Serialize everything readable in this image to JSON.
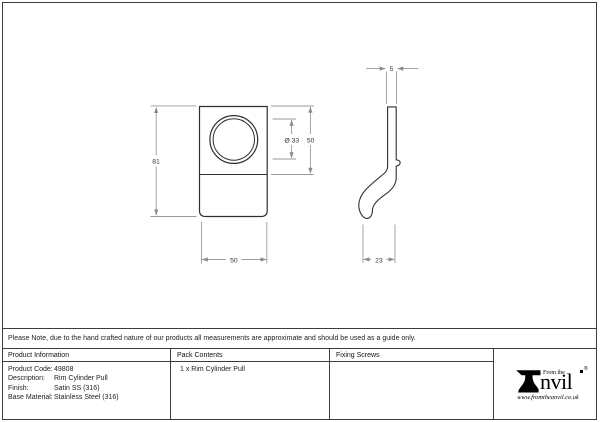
{
  "note_bar": {
    "text": "Please Note, due to the hand crafted nature of our products all measurements are approximate and should be used as a guide only."
  },
  "drawing": {
    "front_view": {
      "overall_height": "81",
      "overall_width": "50",
      "cylinder_diameter": "Ø 33",
      "cylinder_section_height": "50"
    },
    "side_view": {
      "plate_thickness": "5",
      "pull_depth": "23"
    }
  },
  "info_table": {
    "headers": {
      "product_information": "Product Information",
      "pack_contents": "Pack Contents",
      "fixing_screws": "Fixing Screws"
    },
    "product_information": {
      "rows": [
        {
          "label": "Product Code:",
          "value": "49808"
        },
        {
          "label": "Description:",
          "value": "Rim Cylinder Pull"
        },
        {
          "label": "Finish:",
          "value": "Satin SS (316)"
        },
        {
          "label": "Base Material:",
          "value": "Stainless Steel (316)"
        }
      ]
    },
    "pack_contents": {
      "value": "1 x Rim Cylinder Pull"
    }
  },
  "logo": {
    "prefix": "From the",
    "name": "nvil",
    "registered_mark": "®",
    "website": "www.fromtheanvil.co.uk"
  },
  "colors": {
    "outline": "#3c3c3c",
    "dimension_line": "#949494",
    "text": "#1a1a1a",
    "background": "#ffffff"
  }
}
